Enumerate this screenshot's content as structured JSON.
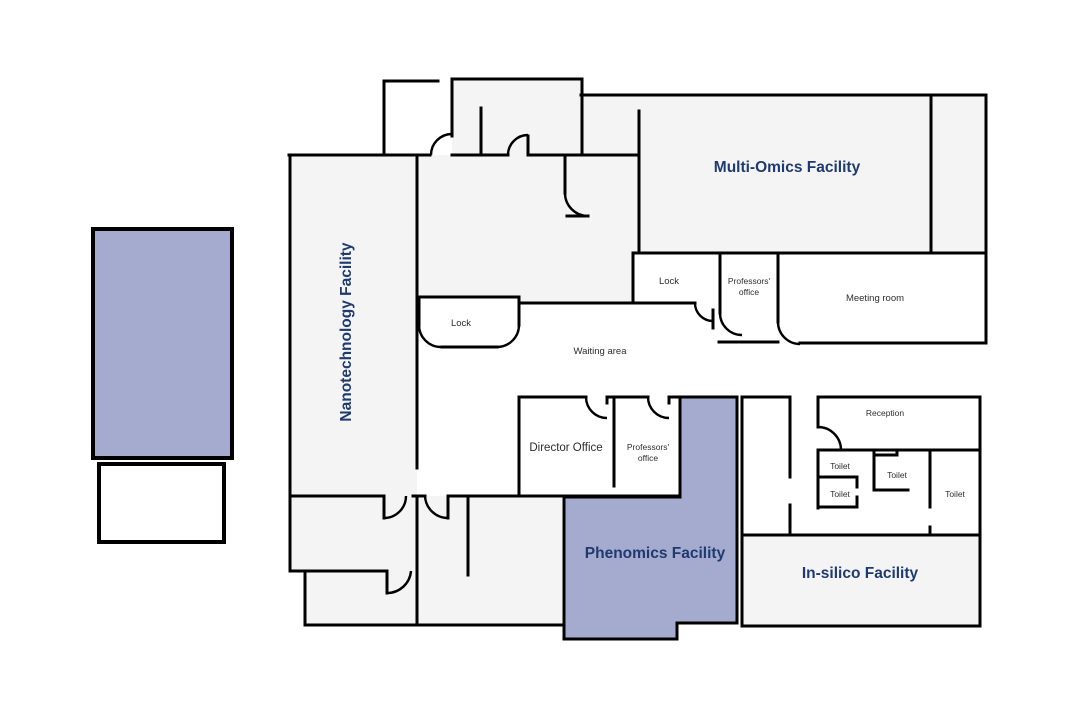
{
  "title": "Laboratory floor plan",
  "colors": {
    "wall": "#000000",
    "room_fill": "#f4f4f5",
    "white_fill": "#ffffff",
    "highlight_fill": "#a4abce",
    "facility_label": "#1f3a6e",
    "room_label": "#2e2e2e"
  },
  "facilities": {
    "nanotechnology": {
      "label": "Nanotechnology Facility"
    },
    "multi_omics": {
      "label": "Multi-Omics Facility"
    },
    "phenomics": {
      "label": "Phenomics Facility"
    },
    "in_silico": {
      "label": "In-silico Facility"
    }
  },
  "rooms": {
    "lock_top": {
      "label": "Lock"
    },
    "professors_office_top": {
      "line1": "Professors'",
      "line2": "office"
    },
    "meeting_room": {
      "label": "Meeting room"
    },
    "lock_middle": {
      "label": "Lock"
    },
    "waiting_area": {
      "label": "Waiting area"
    },
    "director_office": {
      "label": "Director Office"
    },
    "professors_office_middle": {
      "line1": "Professors'",
      "line2": "office"
    },
    "reception": {
      "label": "Reception"
    },
    "toilet_1": {
      "label": "Toilet"
    },
    "toilet_2": {
      "label": "Toilet"
    },
    "toilet_3": {
      "label": "Toilet"
    },
    "toilet_4": {
      "label": "Toilet"
    }
  }
}
